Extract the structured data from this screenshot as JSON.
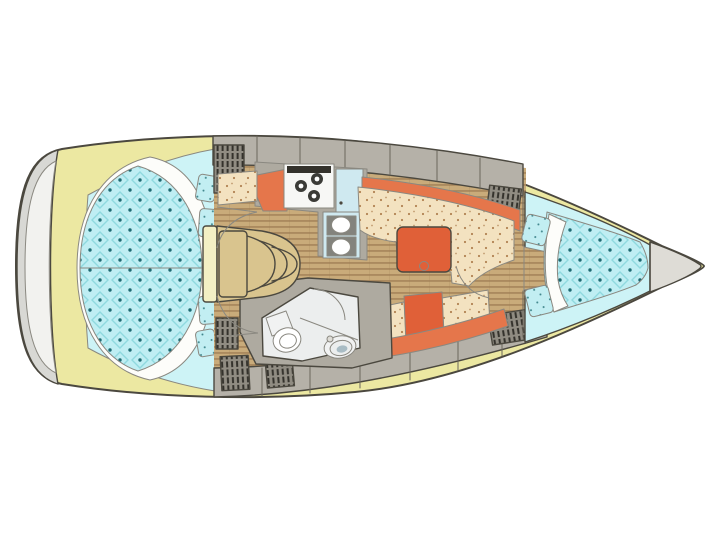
{
  "canvas": {
    "width": 720,
    "height": 540,
    "background": "#ffffff"
  },
  "plan": {
    "type": "sailboat-interior-floor-plan",
    "orientation": "bow-right",
    "rooms": [
      "aft-double-cabin",
      "saloon-with-dinette",
      "galley",
      "head-with-toilet-and-sink",
      "companionway-steps",
      "v-berth-forward-cabin",
      "anchor-locker",
      "swim-platform"
    ]
  },
  "colors": {
    "page_bg": "#ffffff",
    "line": "#4b483f",
    "hull_band": "#ece8a2",
    "transom": "#d8d8d4",
    "transom_panel": "#f2f2ef",
    "deck": "#b5b1a8",
    "counter": "#aeaaa0",
    "wood": "#c9ab7a",
    "wood_stripe": "#9c7a52",
    "cabin_cyan": "#cdf3f6",
    "quilt_cyan": "#bfeef3",
    "quilt_grid": "#8fd9df",
    "quilt_dot": "#1e6a72",
    "sheet": "#fdfdfa",
    "settee": "#f3e2c0",
    "settee_dot": "#a06a38",
    "orange": "#e5764b",
    "table_orange": "#e06038",
    "steps": "#d9c48e",
    "steps_edge": "#f3efc4",
    "head_floor": "#eceeee",
    "locker": "#908c82",
    "hatch": "#34322c",
    "appliance_blue": "#cfe9f0",
    "stove": "#f7f7f5",
    "burner": "#3b3b37",
    "bowl_frame": "#83837d",
    "bow_gray": "#dedcd6",
    "cushion_cyan": "#c2eef2",
    "fixture": "#f1f2f2",
    "sink_inner": "#a9bcc4",
    "white": "#ffffff"
  }
}
